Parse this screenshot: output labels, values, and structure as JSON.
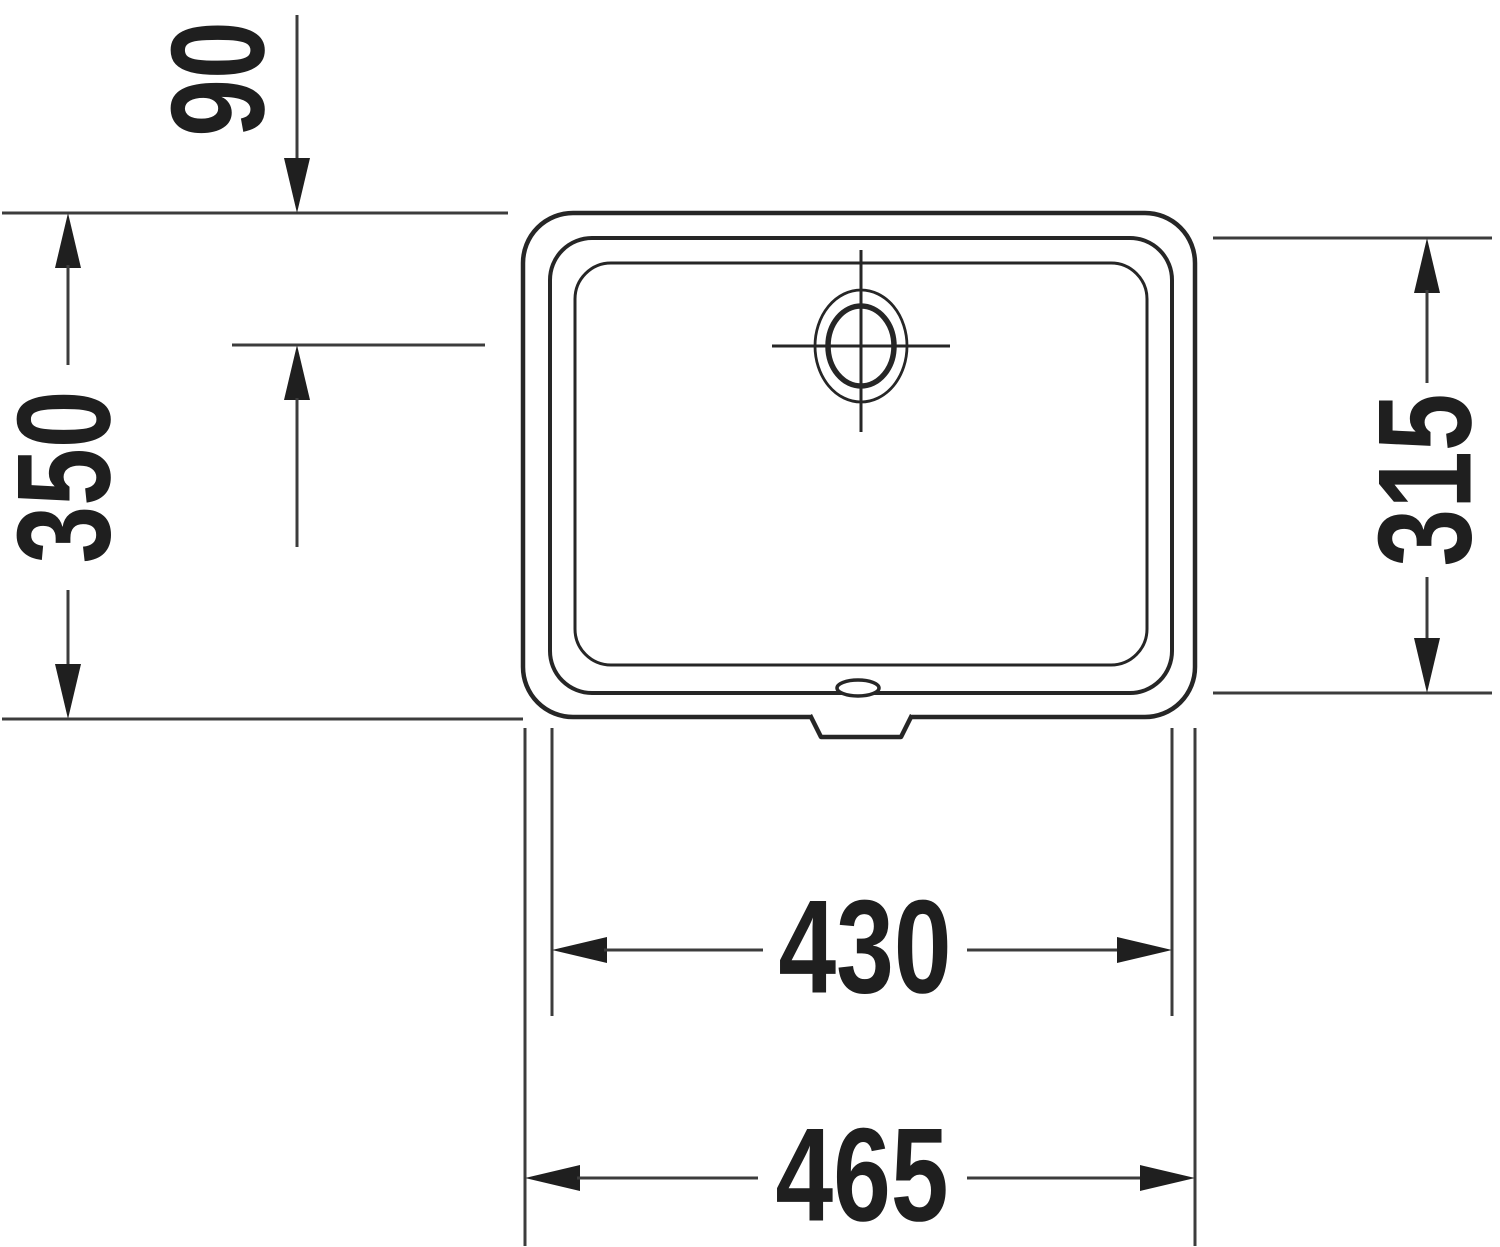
{
  "diagram": {
    "type": "technical-dimension-drawing",
    "subject": "undercounter-washbasin-top-view",
    "unit": "mm",
    "dimensions": {
      "drain_setback": "90",
      "overall_depth": "350",
      "inner_depth": "315",
      "inner_width": "430",
      "overall_width": "465"
    },
    "line_color": "#2a2a2a",
    "dim_line_color": "#3c3c3c",
    "text_color": "#1f1f1f",
    "background": "#ffffff"
  }
}
